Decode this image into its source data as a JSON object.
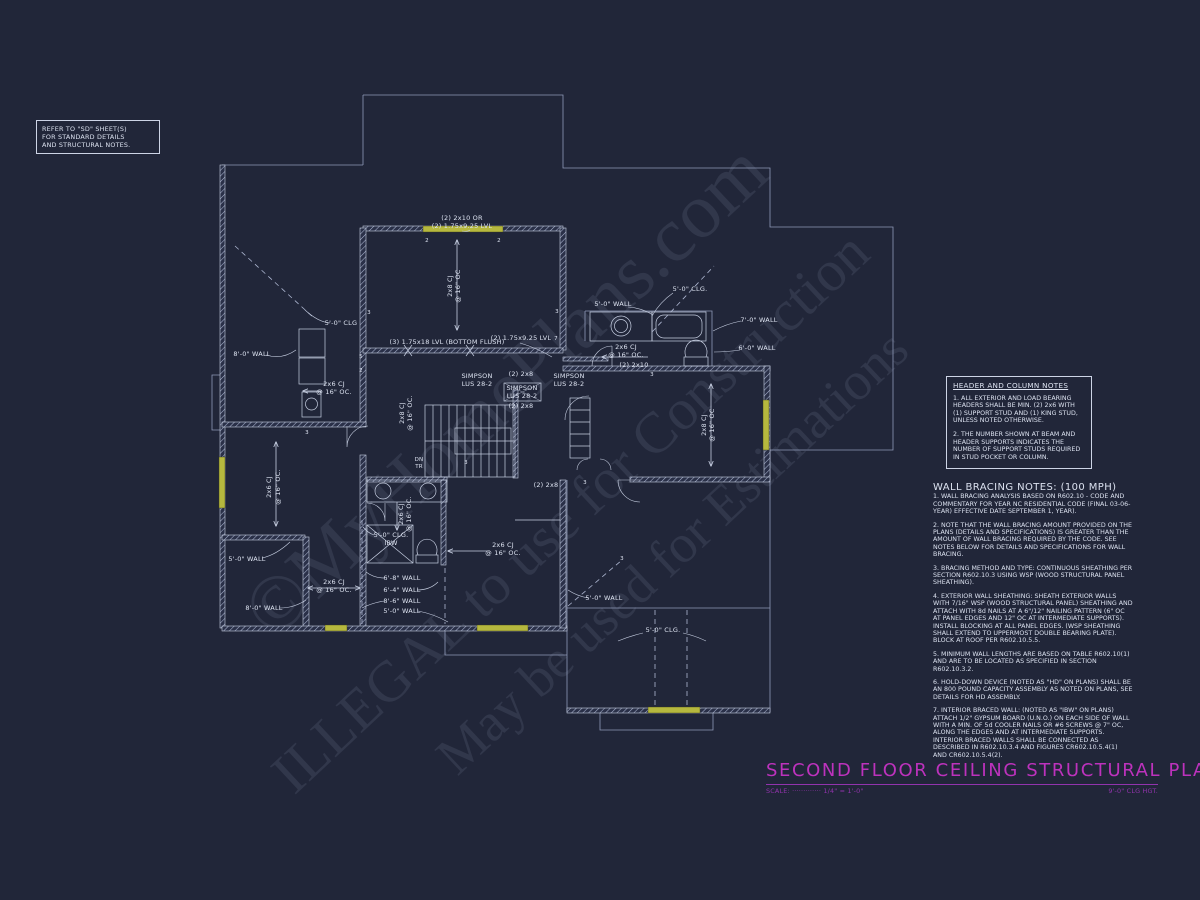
{
  "ref_note": {
    "lines": [
      "REFER TO \"SD\" SHEET(S)",
      "FOR STANDARD DETAILS",
      "AND STRUCTURAL NOTES."
    ]
  },
  "watermarks": [
    {
      "text": "©MyHomePlans.com"
    },
    {
      "text": "ILLEGAL to use for Construction"
    },
    {
      "text": "May be used for Estimations"
    }
  ],
  "header_notes": {
    "title": "HEADER AND COLUMN NOTES",
    "items": [
      "1. ALL EXTERIOR AND LOAD BEARING HEADERS SHALL BE MIN. (2) 2x6 WITH (1) SUPPORT STUD AND (1) KING STUD, UNLESS NOTED OTHERWISE.",
      "2. THE NUMBER SHOWN AT BEAM AND HEADER SUPPORTS INDICATES THE NUMBER OF SUPPORT STUDS REQUIRED IN STUD POCKET OR COLUMN."
    ]
  },
  "bracing_notes": {
    "title": "WALL BRACING NOTES: (100 MPH)",
    "items": [
      "1. WALL BRACING ANALYSIS BASED ON R602.10 - CODE AND COMMENTARY FOR YEAR NC RESIDENTIAL CODE (FINAL 03-06-YEAR) EFFECTIVE DATE SEPTEMBER 1, YEAR).",
      "2. NOTE THAT THE WALL BRACING AMOUNT PROVIDED ON THE PLANS (DETAILS AND SPECIFICATIONS) IS GREATER THAN THE AMOUNT OF WALL BRACING REQUIRED BY THE CODE. SEE NOTES BELOW FOR DETAILS AND SPECIFICATIONS FOR WALL BRACING.",
      "3. BRACING METHOD AND TYPE: CONTINUOUS SHEATHING PER SECTION R602.10.3 USING WSP (WOOD STRUCTURAL PANEL SHEATHING).",
      "4. EXTERIOR WALL SHEATHING: SHEATH EXTERIOR WALLS WITH 7/16\" WSP (WOOD STRUCTURAL PANEL) SHEATHING AND ATTACH WITH 8d NAILS AT A 6\"/12\" NAILING PATTERN (6\" OC AT PANEL EDGES AND 12\" OC AT INTERMEDIATE SUPPORTS). INSTALL BLOCKING AT ALL PANEL EDGES. (WSP SHEATHING SHALL EXTEND TO UPPERMOST DOUBLE BEARING PLATE). BLOCK AT ROOF PER R602.10.5.5.",
      "5. MINIMUM WALL LENGTHS ARE BASED ON TABLE R602.10(1) AND ARE TO BE LOCATED AS SPECIFIED IN SECTION R602.10.3.2.",
      "6. HOLD-DOWN DEVICE (NOTED AS \"HD\" ON PLANS) SHALL BE AN 800 POUND CAPACITY ASSEMBLY AS NOTED ON PLANS, SEE DETAILS FOR HD ASSEMBLY.",
      "7. INTERIOR BRACED WALL: (NOTED AS \"IBW\" ON PLANS) ATTACH 1/2\" GYPSUM BOARD (U.N.O.) ON EACH SIDE OF WALL WITH A MIN. OF 5d COOLER NAILS OR #6 SCREWS @ 7\" OC, ALONG THE EDGES AND AT INTERMEDIATE SUPPORTS. INTERIOR BRACED WALLS SHALL BE CONNECTED AS DESCRIBED IN R602.10.3.4 AND FIGURES CR602.10.5.4(1) AND CR602.10.5.4(2)."
    ]
  },
  "title_block": {
    "title": "SECOND FLOOR CEILING STRUCTURAL PLAN",
    "scale_label": "SCALE:",
    "scale_dots": "·············",
    "scale_value": "1/4\" = 1'-0\"",
    "clg_hgt": "9'-0\" CLG HGT."
  },
  "plan": {
    "labels": [
      {
        "t": "(2) 2x10 OR",
        "x": 462,
        "y": 220
      },
      {
        "t": "(2) 1.75x9.25 LVL",
        "x": 462,
        "y": 228
      },
      {
        "t": "2x8 CJ",
        "x": 452,
        "y": 286,
        "r": -90
      },
      {
        "t": "@ 16\" OC",
        "x": 460,
        "y": 286,
        "r": -90
      },
      {
        "t": "(3) 1.75x18 LVL (BOTTOM FLUSH)",
        "x": 447,
        "y": 344
      },
      {
        "t": "(2) 1.75x9.25 LVL",
        "x": 521,
        "y": 340
      },
      {
        "t": "SIMPSON",
        "x": 477,
        "y": 378
      },
      {
        "t": "LUS 28-2",
        "x": 477,
        "y": 386
      },
      {
        "t": "(2) 2x8",
        "x": 521,
        "y": 376
      },
      {
        "t": "SIMPSON",
        "x": 522,
        "y": 390
      },
      {
        "t": "LUS 28-2",
        "x": 522,
        "y": 398
      },
      {
        "t": "(2) 2x8",
        "x": 521,
        "y": 408
      },
      {
        "t": "SIMPSON",
        "x": 569,
        "y": 378
      },
      {
        "t": "LUS 28-2",
        "x": 569,
        "y": 386
      },
      {
        "t": "(2) 2x8",
        "x": 546,
        "y": 487
      },
      {
        "t": "5'-0\" CLG",
        "x": 341,
        "y": 325
      },
      {
        "t": "8'-0\" WALL",
        "x": 252,
        "y": 356
      },
      {
        "t": "2x6 CJ",
        "x": 334,
        "y": 386
      },
      {
        "t": "@ 16\" OC.",
        "x": 334,
        "y": 394
      },
      {
        "t": "2x6 CJ",
        "x": 271,
        "y": 487,
        "r": -90
      },
      {
        "t": "@ 16\" OC.",
        "x": 280,
        "y": 487,
        "r": -90
      },
      {
        "t": "2x8 CJ",
        "x": 404,
        "y": 413,
        "r": -90
      },
      {
        "t": "@ 16\" OC.",
        "x": 412,
        "y": 413,
        "r": -90
      },
      {
        "t": "5'-0\" WALL",
        "x": 247,
        "y": 561
      },
      {
        "t": "8'-0\" WALL",
        "x": 264,
        "y": 610
      },
      {
        "t": "2x6 CJ",
        "x": 334,
        "y": 584
      },
      {
        "t": "@ 16\" OC.",
        "x": 334,
        "y": 592
      },
      {
        "t": "5'-0\" CLG.",
        "x": 391,
        "y": 537
      },
      {
        "t": "IBW",
        "x": 391,
        "y": 545
      },
      {
        "t": "6'-8\" WALL",
        "x": 402,
        "y": 580
      },
      {
        "t": "6'-4\" WALL",
        "x": 402,
        "y": 592
      },
      {
        "t": "8'-6\" WALL",
        "x": 402,
        "y": 603
      },
      {
        "t": "5'-0\" WALL",
        "x": 402,
        "y": 613
      },
      {
        "t": "2x6 CJ",
        "x": 403,
        "y": 514,
        "r": -90
      },
      {
        "t": "@ 16\" OC.",
        "x": 411,
        "y": 514,
        "r": -90
      },
      {
        "t": "2x6 CJ",
        "x": 503,
        "y": 547
      },
      {
        "t": "@ 16\" OC.",
        "x": 503,
        "y": 555
      },
      {
        "t": "5'-0\" CLG.",
        "x": 690,
        "y": 291
      },
      {
        "t": "5'-0\" WALL",
        "x": 613,
        "y": 306
      },
      {
        "t": "7'-0\" WALL",
        "x": 759,
        "y": 322
      },
      {
        "t": "6'-0\" WALL",
        "x": 757,
        "y": 350
      },
      {
        "t": "2x6 CJ",
        "x": 626,
        "y": 349
      },
      {
        "t": "@ 16\" OC.",
        "x": 626,
        "y": 357
      },
      {
        "t": "(2) 2x10",
        "x": 634,
        "y": 367
      },
      {
        "t": "2x8 CJ",
        "x": 706,
        "y": 425,
        "r": -90
      },
      {
        "t": "@ 16\" OC",
        "x": 714,
        "y": 425,
        "r": -90
      },
      {
        "t": "5'-0\" WALL",
        "x": 604,
        "y": 600
      },
      {
        "t": "5'-0\" CLG.",
        "x": 663,
        "y": 632
      },
      {
        "t": "DN",
        "x": 419,
        "y": 461,
        "fs": 5.5
      },
      {
        "t": "TR",
        "x": 419,
        "y": 468,
        "fs": 5.5
      }
    ],
    "stud_markers": [
      {
        "t": "2",
        "x": 427,
        "y": 242
      },
      {
        "t": "2",
        "x": 499,
        "y": 242
      },
      {
        "t": "3",
        "x": 369,
        "y": 314
      },
      {
        "t": "5",
        "x": 361,
        "y": 358
      },
      {
        "t": "2",
        "x": 361,
        "y": 372
      },
      {
        "t": "3",
        "x": 557,
        "y": 313
      },
      {
        "t": "7",
        "x": 556,
        "y": 340
      },
      {
        "t": "3",
        "x": 307,
        "y": 434
      },
      {
        "t": "3",
        "x": 466,
        "y": 464
      },
      {
        "t": "3",
        "x": 652,
        "y": 376
      },
      {
        "t": "3",
        "x": 622,
        "y": 560
      },
      {
        "t": "3",
        "x": 585,
        "y": 484
      }
    ],
    "colors": {
      "line": "#c7cfe2",
      "highlight_yellow": "#b6b83e",
      "title_magenta": "#bd32bd",
      "background": "#212639"
    }
  }
}
